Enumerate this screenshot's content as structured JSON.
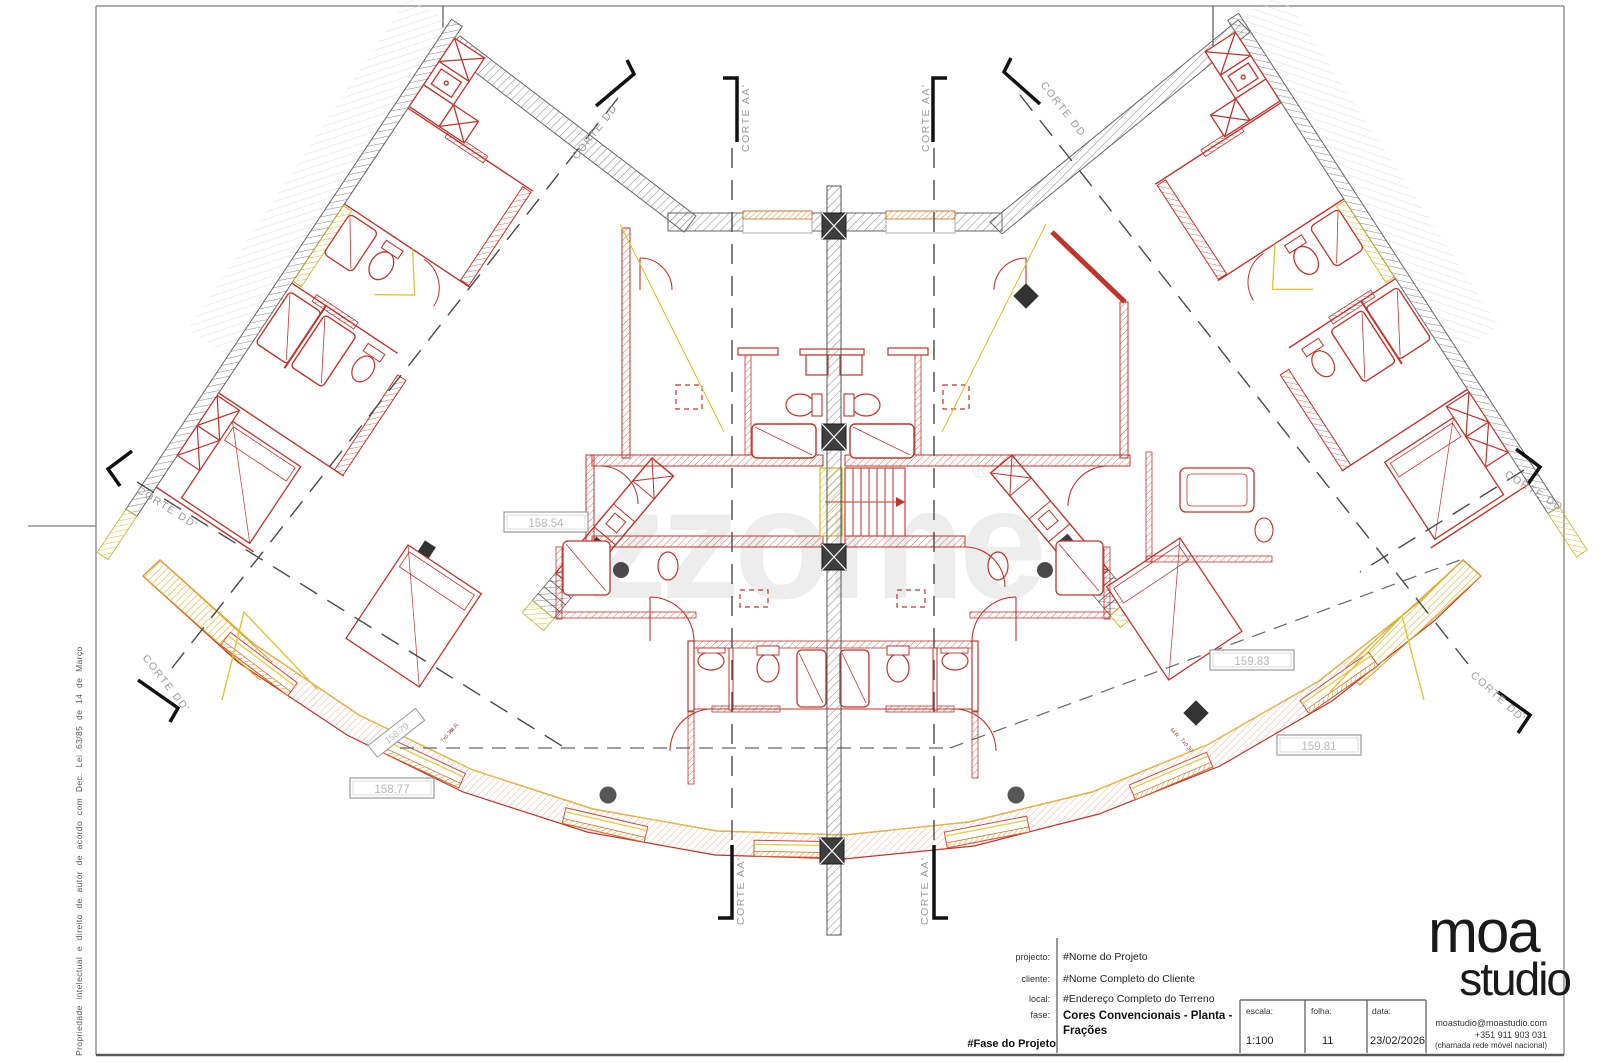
{
  "sheet": {
    "copyright": "Propriedade intelectual e direito de autor de acordo com Dec. Lei 63/85 de 14 de Março"
  },
  "watermark": {
    "text": "zzome",
    "reg": "®"
  },
  "labels": {
    "corte_aa": "CORTE AA'",
    "corte_dd": "CORTE DD",
    "corte_dd2": "CORTE DD'"
  },
  "elevations": {
    "a": "158.54",
    "b": "159.83",
    "c": "159.81",
    "d": "158.77",
    "e": "158.79"
  },
  "notes": {
    "mr": "M.R.",
    "steps": "7x0.30"
  },
  "title_block": {
    "project_label": "projecto:",
    "project_value": "#Nome do Projeto",
    "client_label": "cliente:",
    "client_value": "#Nome Completo do Cliente",
    "site_label": "local:",
    "site_value": "#Endereço Completo do Terreno",
    "phase_label": "fase:",
    "phase_value_line1": "Cores Convencionais - Planta -",
    "phase_value_line2": "Frações",
    "phase_name": "#Fase do Projeto",
    "scale_label": "escala:",
    "scale_value": "1:100",
    "sheet_label": "folha:",
    "sheet_value": "11",
    "date_label": "data:",
    "date_value": "23/02/2026",
    "logo_line1": "moa",
    "logo_line2": "studio",
    "contact_email": "moastudio@moastudio.com",
    "contact_phone": "+351 911 903 031",
    "contact_note": "(chamada rede móvel nacional)"
  }
}
